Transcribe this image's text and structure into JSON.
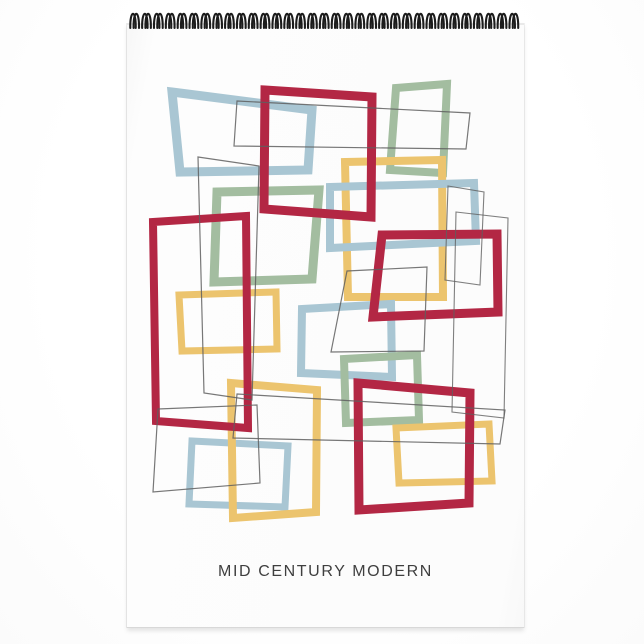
{
  "title": {
    "text": "MID CENTURY MODERN"
  },
  "palette": {
    "red": "#b32744",
    "blue": "#a9c6d3",
    "green": "#a3bda0",
    "yellow": "#ecc46e",
    "line": "#5f5f5f",
    "coil": "#1c1c1c",
    "page": "#fcfcfc",
    "backdrop": "#ffffff",
    "title_color": "#3f3f3f"
  },
  "artwork": {
    "description": "overlapping-rectangle-frames-abstract",
    "frames": [
      {
        "id": "blue-frame-1",
        "color": "blue",
        "stroke_width": 9,
        "opacity": 1,
        "points": [
          [
            172,
            92
          ],
          [
            312,
            110
          ],
          [
            308,
            170
          ],
          [
            180,
            172
          ]
        ]
      },
      {
        "id": "green-frame-1",
        "color": "green",
        "stroke_width": 8,
        "opacity": 1,
        "points": [
          [
            396,
            88
          ],
          [
            447,
            84
          ],
          [
            443,
            173
          ],
          [
            390,
            170
          ]
        ]
      },
      {
        "id": "yellow-frame-1",
        "color": "yellow",
        "stroke_width": 8,
        "opacity": 1,
        "points": [
          [
            345,
            162
          ],
          [
            442,
            160
          ],
          [
            443,
            297
          ],
          [
            348,
            297
          ]
        ]
      },
      {
        "id": "blue-frame-2",
        "color": "blue",
        "stroke_width": 8,
        "opacity": 1,
        "points": [
          [
            330,
            187
          ],
          [
            474,
            183
          ],
          [
            476,
            241
          ],
          [
            330,
            248
          ]
        ]
      },
      {
        "id": "green-frame-2",
        "color": "green",
        "stroke_width": 9,
        "opacity": 1,
        "points": [
          [
            217,
            192
          ],
          [
            319,
            190
          ],
          [
            312,
            279
          ],
          [
            214,
            282
          ]
        ]
      },
      {
        "id": "yellow-frame-2",
        "color": "yellow",
        "stroke_width": 7,
        "opacity": 1,
        "points": [
          [
            179,
            295
          ],
          [
            276,
            292
          ],
          [
            277,
            349
          ],
          [
            182,
            351
          ]
        ]
      },
      {
        "id": "blue-frame-3",
        "color": "blue",
        "stroke_width": 8,
        "opacity": 1,
        "points": [
          [
            302,
            309
          ],
          [
            391,
            304
          ],
          [
            392,
            377
          ],
          [
            301,
            373
          ]
        ]
      },
      {
        "id": "green-frame-3",
        "color": "green",
        "stroke_width": 8,
        "opacity": 1,
        "points": [
          [
            344,
            359
          ],
          [
            417,
            355
          ],
          [
            419,
            420
          ],
          [
            346,
            423
          ]
        ]
      },
      {
        "id": "blue-frame-4",
        "color": "blue",
        "stroke_width": 7,
        "opacity": 1,
        "points": [
          [
            192,
            441
          ],
          [
            288,
            446
          ],
          [
            285,
            507
          ],
          [
            189,
            504
          ]
        ]
      },
      {
        "id": "yellow-frame-3",
        "color": "yellow",
        "stroke_width": 8,
        "opacity": 1,
        "points": [
          [
            231,
            383
          ],
          [
            317,
            390
          ],
          [
            316,
            512
          ],
          [
            233,
            518
          ]
        ]
      },
      {
        "id": "yellow-frame-4",
        "color": "yellow",
        "stroke_width": 7,
        "opacity": 1,
        "points": [
          [
            396,
            428
          ],
          [
            489,
            424
          ],
          [
            492,
            481
          ],
          [
            399,
            483
          ]
        ]
      },
      {
        "id": "red-frame-1",
        "color": "red",
        "stroke_width": 9,
        "opacity": 1,
        "points": [
          [
            265,
            90
          ],
          [
            372,
            97
          ],
          [
            371,
            217
          ],
          [
            264,
            209
          ]
        ]
      },
      {
        "id": "red-frame-2",
        "color": "red",
        "stroke_width": 9,
        "opacity": 1,
        "points": [
          [
            382,
            235
          ],
          [
            497,
            234
          ],
          [
            498,
            312
          ],
          [
            373,
            317
          ]
        ]
      },
      {
        "id": "red-frame-3",
        "color": "red",
        "stroke_width": 8,
        "opacity": 1,
        "points": [
          [
            153,
            222
          ],
          [
            246,
            216
          ],
          [
            248,
            428
          ],
          [
            156,
            421
          ]
        ]
      },
      {
        "id": "red-frame-4",
        "color": "red",
        "stroke_width": 9,
        "opacity": 1,
        "points": [
          [
            358,
            383
          ],
          [
            470,
            393
          ],
          [
            469,
            503
          ],
          [
            359,
            510
          ]
        ]
      },
      {
        "id": "line-frame-1",
        "color": "line",
        "stroke_width": 1.2,
        "opacity": 0.85,
        "points": [
          [
            237,
            101
          ],
          [
            470,
            113
          ],
          [
            466,
            149
          ],
          [
            234,
            146
          ]
        ]
      },
      {
        "id": "line-frame-2",
        "color": "line",
        "stroke_width": 1.2,
        "opacity": 0.85,
        "points": [
          [
            198,
            157
          ],
          [
            259,
            166
          ],
          [
            252,
            400
          ],
          [
            204,
            393
          ]
        ]
      },
      {
        "id": "line-frame-3",
        "color": "line",
        "stroke_width": 1.2,
        "opacity": 0.85,
        "points": [
          [
            347,
            271
          ],
          [
            427,
            267
          ],
          [
            424,
            351
          ],
          [
            331,
            352
          ]
        ]
      },
      {
        "id": "line-frame-4",
        "color": "line",
        "stroke_width": 1.1,
        "opacity": 0.8,
        "points": [
          [
            448,
            186
          ],
          [
            484,
            192
          ],
          [
            480,
            285
          ],
          [
            445,
            280
          ]
        ]
      },
      {
        "id": "line-frame-5",
        "color": "line",
        "stroke_width": 1.1,
        "opacity": 0.8,
        "points": [
          [
            456,
            212
          ],
          [
            508,
            218
          ],
          [
            504,
            418
          ],
          [
            452,
            412
          ]
        ]
      },
      {
        "id": "line-frame-6",
        "color": "line",
        "stroke_width": 1.2,
        "opacity": 0.85,
        "points": [
          [
            237,
            394
          ],
          [
            505,
            410
          ],
          [
            500,
            444
          ],
          [
            233,
            438
          ]
        ]
      },
      {
        "id": "line-frame-7",
        "color": "line",
        "stroke_width": 1.2,
        "opacity": 0.85,
        "points": [
          [
            158,
            409
          ],
          [
            257,
            405
          ],
          [
            260,
            483
          ],
          [
            153,
            492
          ]
        ]
      }
    ]
  },
  "binding": {
    "coil_count": 33,
    "start_x": 133,
    "spacing": 11.85,
    "loop_top": 9,
    "loop_bottom": 28,
    "wire_offsets": [
      0,
      3.3
    ],
    "wire_width": 2.1,
    "arch_half": 2.7
  }
}
